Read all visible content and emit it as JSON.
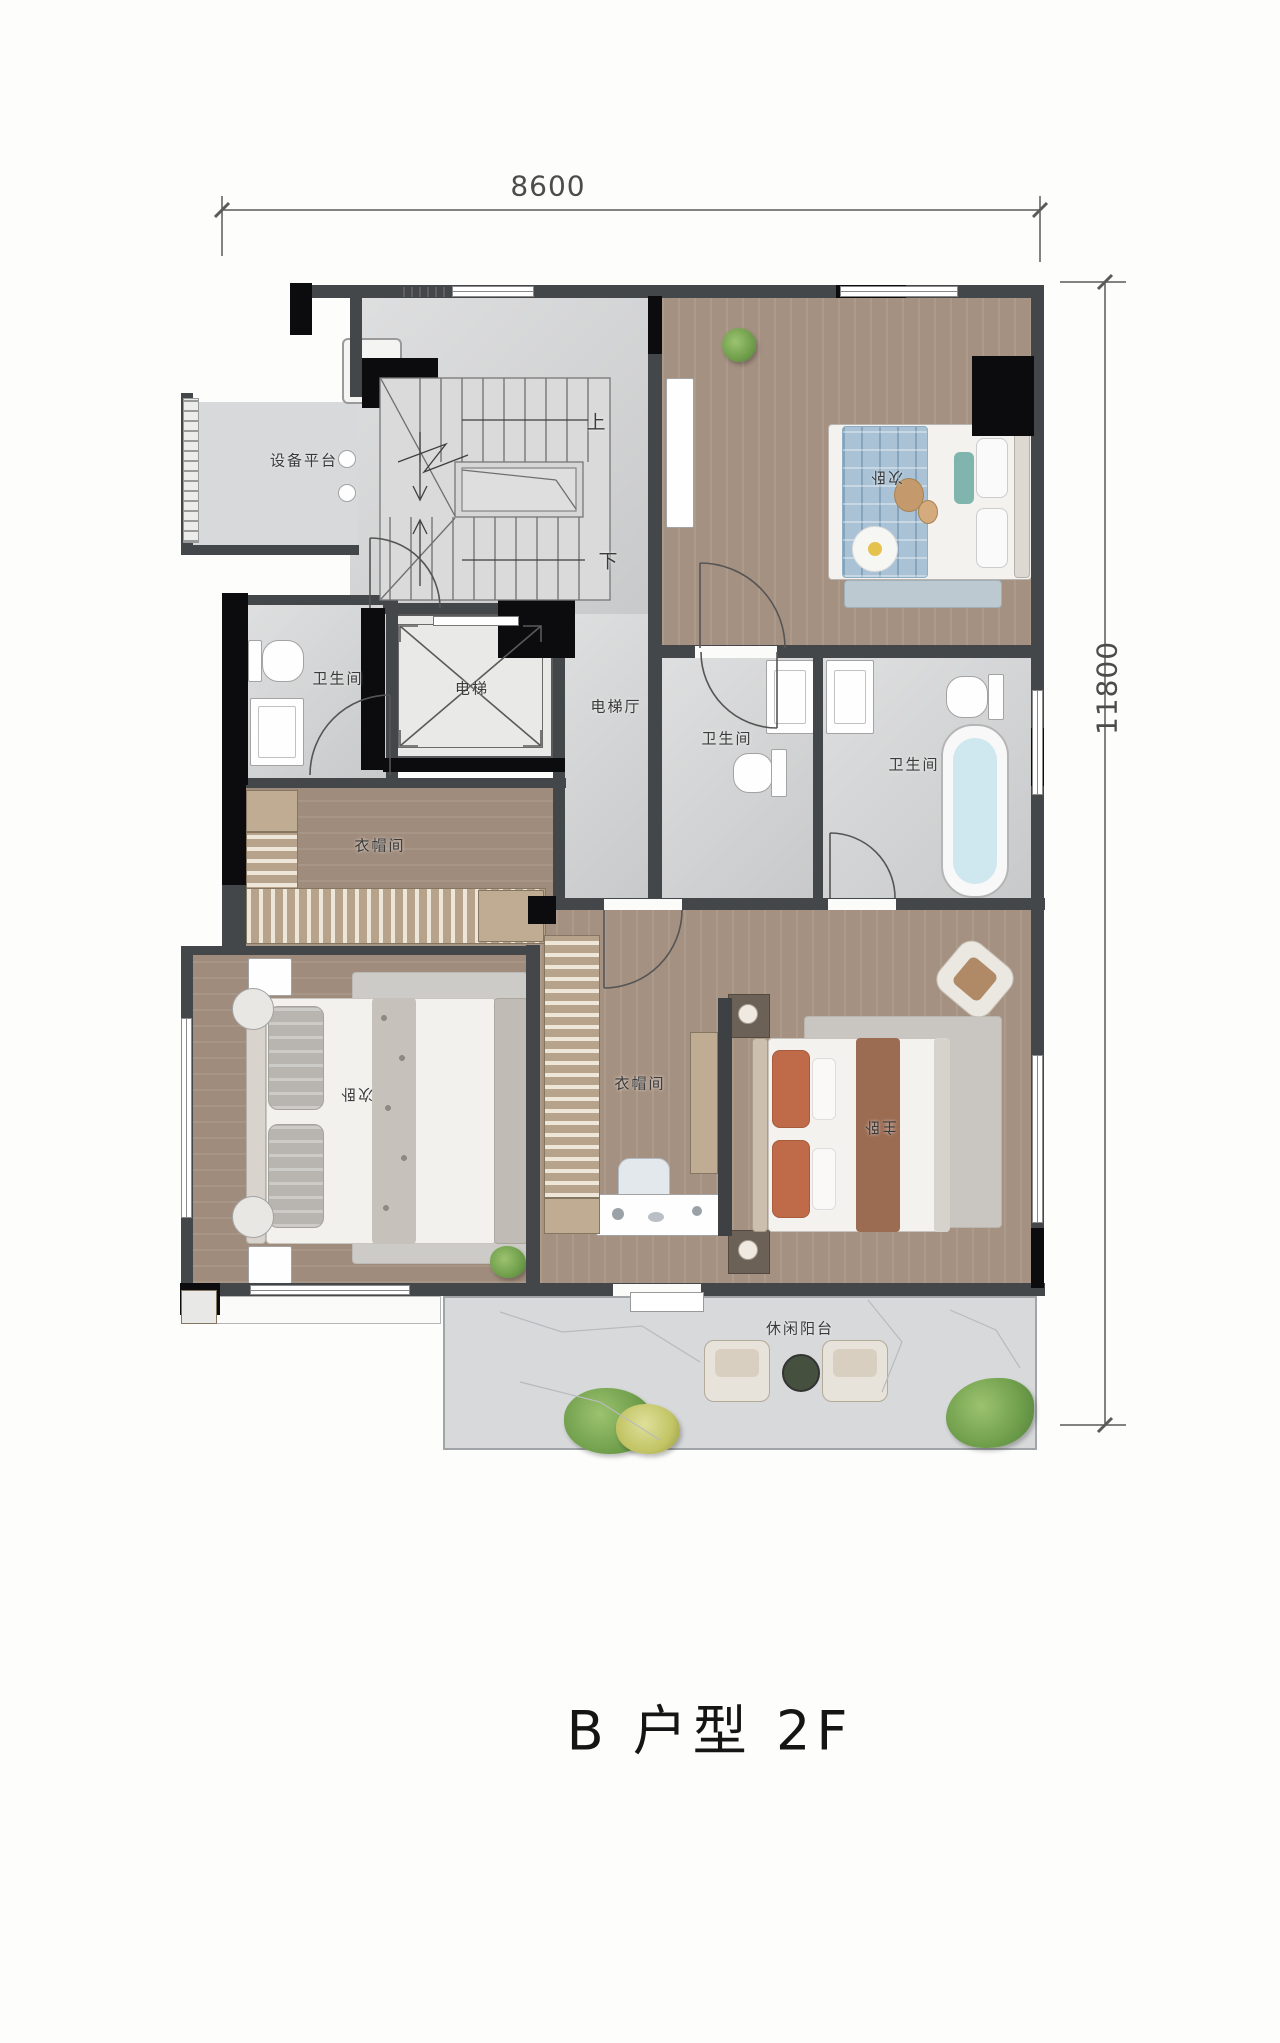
{
  "title": "B 户型 2F",
  "dimensions": {
    "width_top": "8600",
    "height_right": "11800"
  },
  "stairs": {
    "up_label": "上",
    "down_label": "下"
  },
  "rooms": {
    "equipment_platform": {
      "label": "设备平台"
    },
    "bathroom_left": {
      "label": "卫生间"
    },
    "elevator": {
      "label": "电梯"
    },
    "elevator_hall": {
      "label": "电梯厅"
    },
    "bedroom_top_right": {
      "label": "次卧"
    },
    "bathroom_middle": {
      "label": "卫生间"
    },
    "bathroom_master": {
      "label": "卫生间"
    },
    "cloakroom_upper": {
      "label": "衣帽间"
    },
    "bedroom_lower_left": {
      "label": "次卧"
    },
    "cloakroom_master": {
      "label": "衣帽间"
    },
    "master_bedroom": {
      "label": "主卧"
    },
    "balcony": {
      "label": "休闲阳台"
    }
  },
  "colors": {
    "wall": "#44474a",
    "wall_black": "#0c0c0e",
    "wood_floor": "#a59181",
    "tile_floor": "#d3d4d5",
    "accent_teal": "#49b0a4",
    "bed_plaid_blue": "#a9c2d5",
    "pillow_terracotta": "#bf6a48",
    "bath_water": "#cfe7ee",
    "plant_green": "#6f9e4b"
  }
}
